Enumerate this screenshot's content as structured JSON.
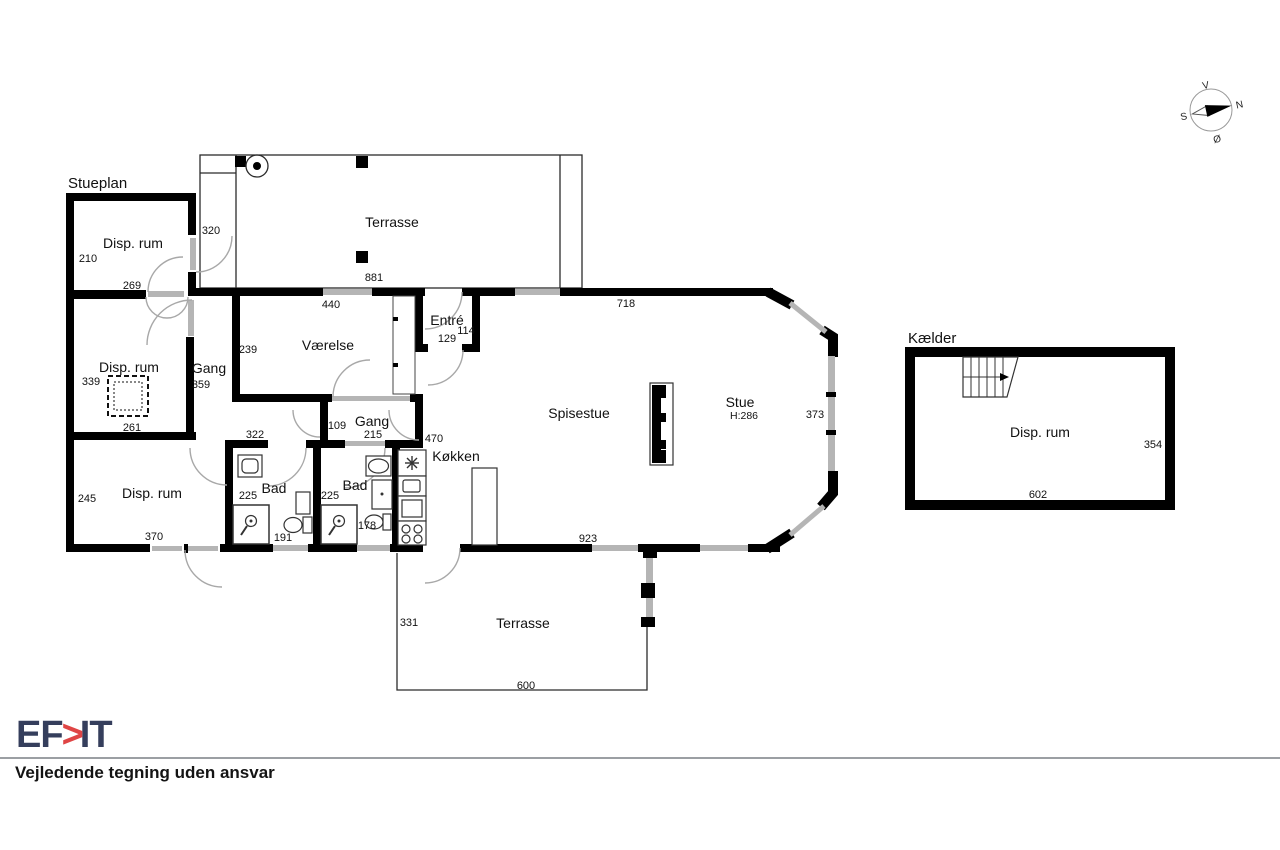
{
  "titles": {
    "stueplan": "Stueplan",
    "kaelder": "Kælder"
  },
  "rooms": {
    "disp_nw": "Disp. rum",
    "disp_w": "Disp. rum",
    "disp_sw": "Disp. rum",
    "gang_w": "Gang",
    "vaerelse": "Værelse",
    "entre": "Entré",
    "gang_m": "Gang",
    "bad_l": "Bad",
    "bad_r": "Bad",
    "koekken": "Køkken",
    "spisestue": "Spisestue",
    "stue": "Stue",
    "stue_height": "H:286",
    "terrasse_n": "Terrasse",
    "terrasse_s": "Terrasse",
    "kaelder_disp": "Disp. rum"
  },
  "dims": {
    "d210": "210",
    "d269": "269",
    "d320": "320",
    "d339": "339",
    "d359": "359",
    "d261": "261",
    "d239": "239",
    "d881": "881",
    "d440": "440",
    "d114": "114",
    "d129": "129",
    "d718": "718",
    "d373": "373",
    "d322": "322",
    "d109": "109",
    "d215": "215",
    "d470": "470",
    "d245": "245",
    "d225l": "225",
    "d225r": "225",
    "d178": "178",
    "d191": "191",
    "d370": "370",
    "d923": "923",
    "d331": "331",
    "d600": "600",
    "d354": "354",
    "d602": "602"
  },
  "compass": {
    "n": "N",
    "s": "S",
    "e": "Ø",
    "w": "V"
  },
  "footer": {
    "logo_left": "EF",
    "logo_chevron": ">",
    "logo_right": "IT",
    "disclaimer": "Vejledende tegning uden ansvar"
  },
  "colors": {
    "logo_navy": "#353e5c",
    "logo_red": "#df4545",
    "wall_black": "#000000",
    "window_gray": "#b5b5b5"
  }
}
